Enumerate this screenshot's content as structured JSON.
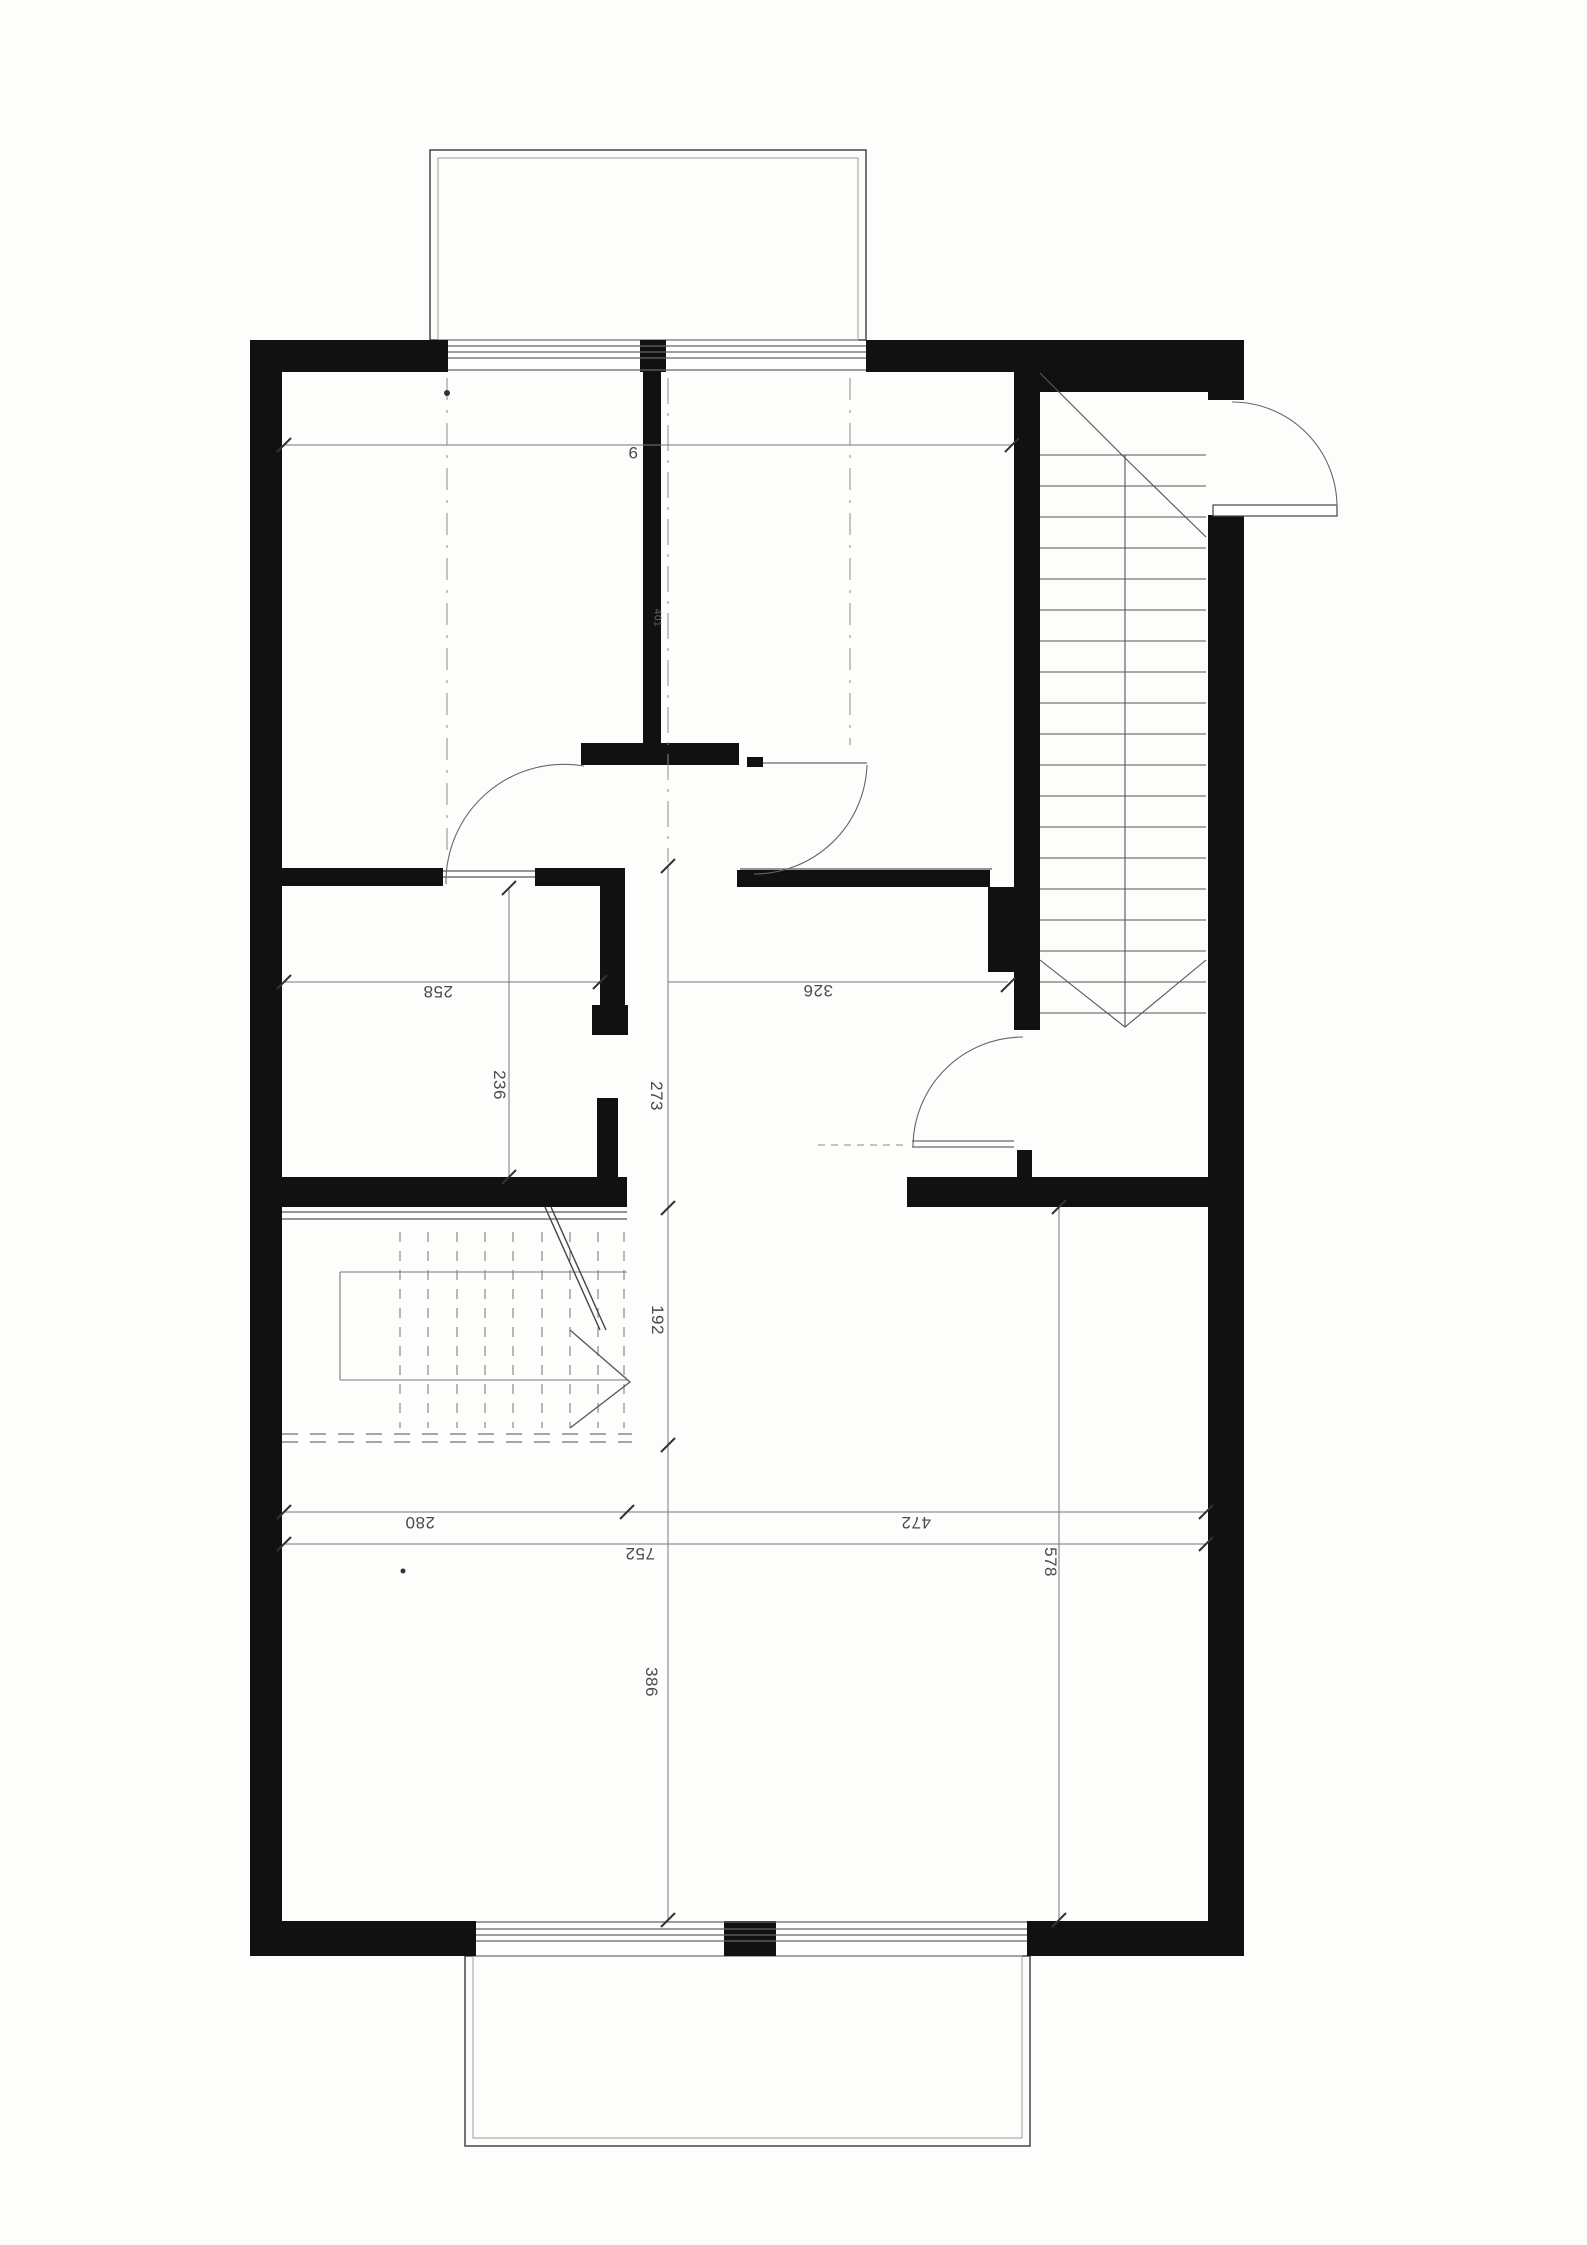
{
  "plan": {
    "type": "scanned floor plan, upper storey",
    "dimensions": {
      "top_width_partial": "9",
      "room_left_width": "258",
      "hall_width": "326",
      "small_room_depth": "236",
      "hall_depth": "273",
      "center_wall_label": "401",
      "stair_depth": "192",
      "living_left_width": "280",
      "living_right_width": "472",
      "living_total_width": "752",
      "right_side_depth": "578",
      "living_room_depth": "386"
    },
    "colors": {
      "wall": "#111111",
      "paper": "#fdfdfc",
      "thin_line": "#555555",
      "dim_text": "#4a4a4a",
      "dashed_line": "#8a8a8a"
    }
  }
}
